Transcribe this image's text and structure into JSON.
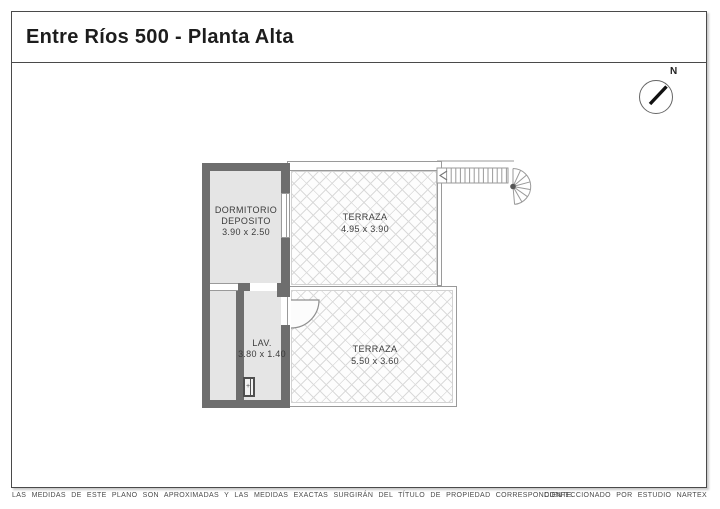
{
  "title": "Entre Ríos 500 - Planta Alta",
  "compass": {
    "north_label": "N"
  },
  "plan": {
    "rooms": {
      "dormitorio": {
        "name": "DORMITORIO",
        "name2": "DEPOSITO",
        "dims": "3.90 x 2.50"
      },
      "terraza_top": {
        "name": "TERRAZA",
        "dims": "4.95 x 3.90"
      },
      "lav": {
        "name": "LAV.",
        "dims": "3.80 x 1.40"
      },
      "terraza_bottom": {
        "name": "TERRAZA",
        "dims": "5.50 x 3.60"
      }
    },
    "fixtures": {
      "washer_mark": "+"
    }
  },
  "footer": {
    "disclaimer": "LAS MEDIDAS DE ESTE PLANO SON APROXIMADAS Y LAS MEDIDAS EXACTAS SURGIRÁN DEL TÍTULO DE PROPIEDAD CORRESPONDIENTE.",
    "credit": "CONFECCIONADO POR ESTUDIO NARTEX"
  },
  "colors": {
    "wall": "#6e6e6e",
    "room_fill": "#e5e5e5",
    "outline": "#9a9a9a",
    "hatch_line": "#dadada",
    "text": "#3c3c3c",
    "frame": "#4a4a4a"
  }
}
